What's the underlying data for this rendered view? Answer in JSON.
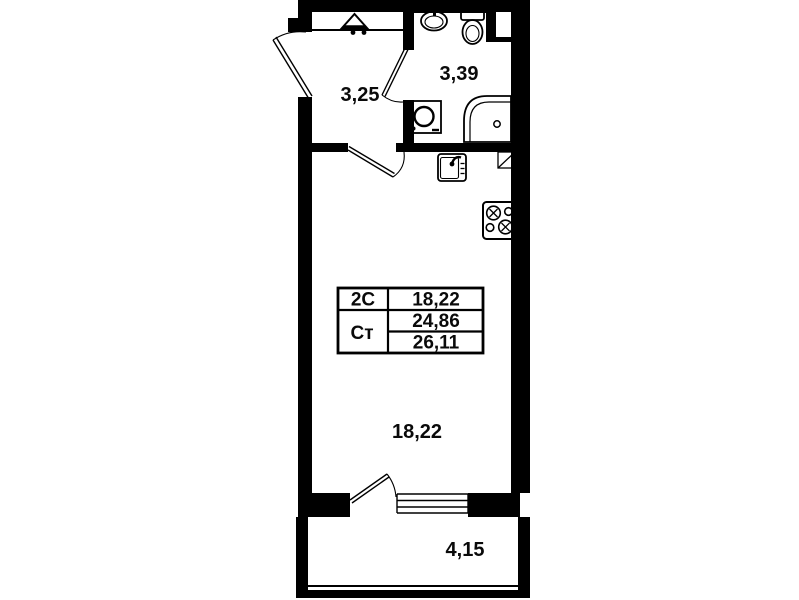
{
  "colors": {
    "ink": "#000000",
    "paper": "#ffffff"
  },
  "rooms": [
    {
      "id": "hallway",
      "area": "3,25"
    },
    {
      "id": "bathroom",
      "area": "3,39"
    },
    {
      "id": "living-room",
      "area": "18,22"
    },
    {
      "id": "balcony",
      "area": "4,15"
    }
  ],
  "area_table": {
    "rows": [
      {
        "label": "2С",
        "value": "18,22"
      },
      {
        "label": "Ст",
        "value": "24,86"
      },
      {
        "label": "",
        "value": "26,11"
      }
    ]
  },
  "fixtures": [
    "entrance-marker",
    "washbasin",
    "toilet",
    "washing-machine",
    "shower",
    "kitchen-sink",
    "stove",
    "vent-duct",
    "window",
    "balcony-glazing"
  ]
}
